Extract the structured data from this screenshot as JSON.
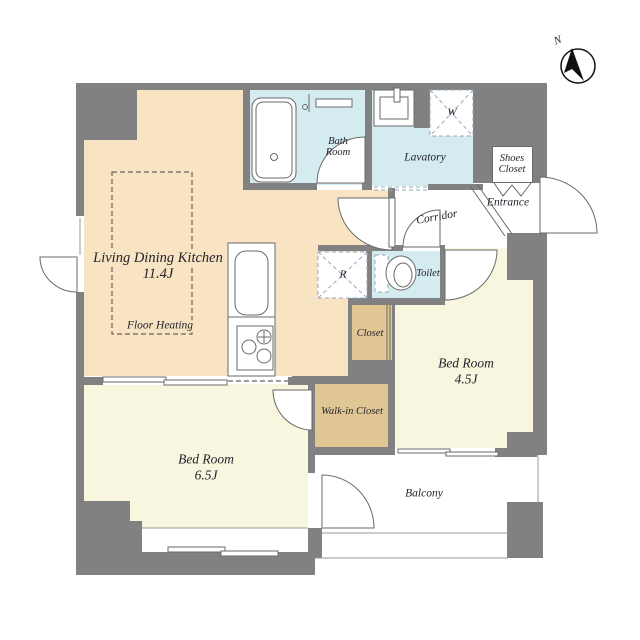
{
  "labels": {
    "ldk_title": "Living Dining Kitchen",
    "ldk_size": "11.4J",
    "floor_heating": "Floor Heating",
    "bath_l1": "Bath",
    "bath_l2": "Room",
    "lavatory": "Lavatory",
    "shoes_l1": "Shoes",
    "shoes_l2": "Closet",
    "entrance": "Entrance",
    "corridor": "Corridor",
    "toilet": "Toilet",
    "refrigerator_mark": "R",
    "washer_mark": "W",
    "closet": "Closet",
    "walk_in_closet": "Walk-in Closet",
    "bedroom45_name": "Bed Room",
    "bedroom45_size": "4.5J",
    "bedroom65_name": "Bed Room",
    "bedroom65_size": "6.5J",
    "balcony": "Balcony",
    "compass_north": "N"
  },
  "colors": {
    "wall": "#818181",
    "line": "#6a6a6a",
    "winline": "#9a9a9a",
    "text": "#23232e",
    "ldk": "#f8e3c3",
    "bedroom": "#f8f6de",
    "wet": "#d4ebf0",
    "closet": "#dfc693",
    "dashblue": "#93a9bd",
    "dashheat": "#6e6258"
  }
}
